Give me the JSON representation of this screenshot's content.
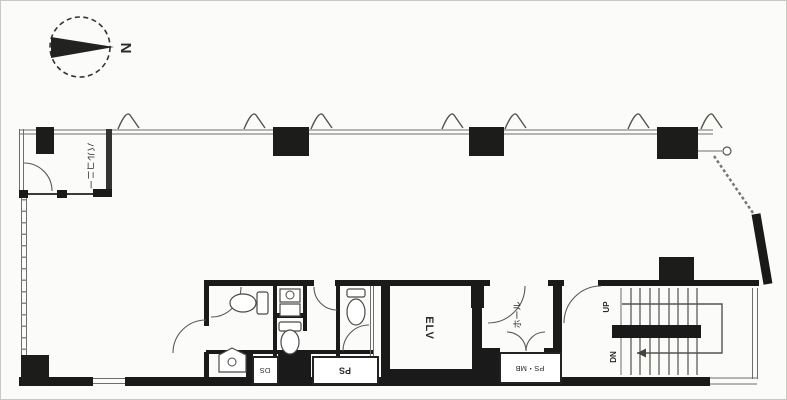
{
  "document": {
    "type": "architectural-floor-plan"
  },
  "compass": {
    "north_label": "N"
  },
  "labels": {
    "balcony": "バルコニー",
    "elevator": "ELV",
    "hall": "ホール",
    "pipe_shaft": "PS",
    "meter_box": "PS・MB",
    "duct_shaft": "DS",
    "stair_up": "UP",
    "stair_down": "DN"
  },
  "colors": {
    "wall": "#1a1a1a",
    "line": "#5a5a57",
    "background": "#fbfbf9"
  }
}
